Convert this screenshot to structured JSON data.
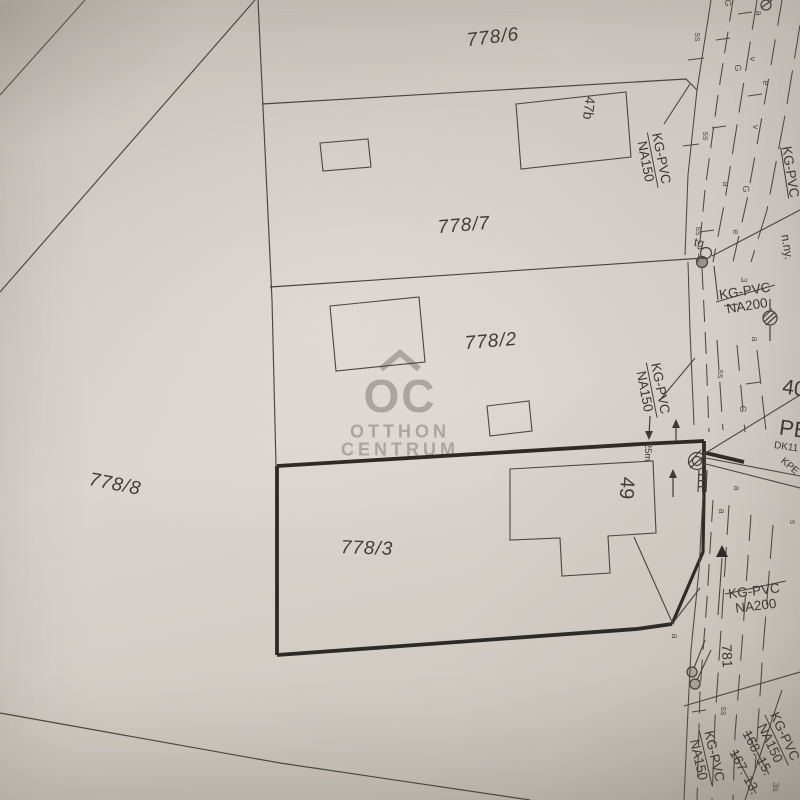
{
  "colors": {
    "paper": "#d3cdc7",
    "ink": "#46413b",
    "bold_parcel_outline": "#2d2924",
    "watermark": "#a6a19b"
  },
  "watermark": {
    "monogram": "OC",
    "line1": "OTTHON",
    "line2": "CENTRUM"
  },
  "parcels": {
    "p778_6": "778/6",
    "p778_7": "778/7",
    "p778_2": "778/2",
    "p778_8": "778/8",
    "p778_3": "778/3"
  },
  "buildings": {
    "b47b": "47b",
    "b49": "49"
  },
  "utilities": {
    "kgpvc_na150_top": {
      "line1": "KG-PVC",
      "line2": "NA150"
    },
    "kgpvc_right": "KG-PVC",
    "n_ny": "n.ny.",
    "tg": "tg",
    "kgpvc_na200_upper": {
      "line1": "KG-PVC",
      "line2": "NA200"
    },
    "kgpvc_na150_mid": {
      "line1": "KG-PVC",
      "line2": "NA150"
    },
    "pipe_40": "40",
    "pipe_pe": "PE",
    "pipe_dk11": "DK11",
    "pipe_kpe": "KPE",
    "dim_25m": "25m",
    "kgpvc_na200_lower": {
      "line1": "KG-PVC",
      "line2": "NA200"
    },
    "num_781": "781",
    "kgpvc_na150_bottom_left": {
      "line1": "KG-PVC",
      "line2": "NA150"
    },
    "kgpvc_na150_bottom_right": {
      "line1": "KG-PVC",
      "line2": "NA150"
    },
    "num_168_15": "168. 15.",
    "num_167_13": "167. 13."
  },
  "road_marks": [
    "G",
    "a",
    "ss",
    "v",
    "G",
    "e",
    "ss",
    "v",
    "a",
    "G",
    "e",
    "ss",
    "3",
    "a",
    "ss",
    "G",
    "a",
    "a",
    "a",
    "s",
    "ss",
    "3s"
  ]
}
